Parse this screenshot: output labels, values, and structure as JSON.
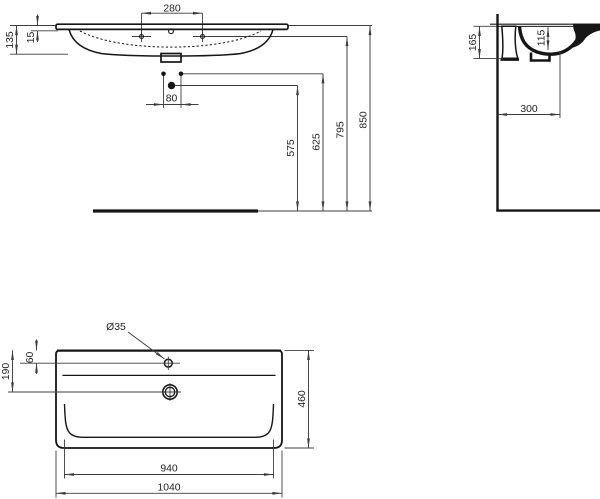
{
  "drawing": {
    "type": "washbasin-installation-technical-drawing",
    "views": {
      "front": "front-elevation",
      "side": "side-section",
      "plan": "top-plan"
    }
  },
  "dims": {
    "front": {
      "tap_spacing": "280",
      "rim_height": "135",
      "rim_thickness": "15",
      "fixing_spacing": "80",
      "drain_height": "575",
      "fixing_height": "625",
      "tap_height": "795",
      "total_height": "850"
    },
    "side": {
      "basin_depth": "165",
      "bowl_depth": "115",
      "drain_distance": "300"
    },
    "plan": {
      "tap_hole_dia": "Ø35",
      "tap_offset": "60",
      "drain_offset": "190",
      "depth": "460",
      "bowl_width": "940",
      "width": "1040"
    }
  }
}
